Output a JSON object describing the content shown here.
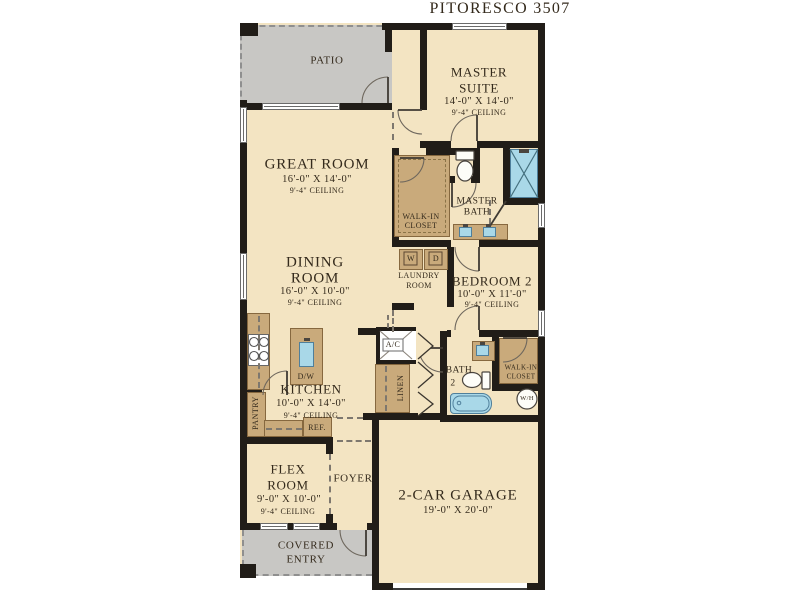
{
  "title": "PITORESCO 3507",
  "colors": {
    "floor": "#f3e4c2",
    "porch": "#c8c7c4",
    "wall": "#211d18",
    "cabinet": "#c9aa7b",
    "fixture_blue": "#a9d8e8",
    "text": "#342a1c"
  },
  "rooms": {
    "patio": {
      "name": "PATIO"
    },
    "master_suite": {
      "name_line1": "MASTER",
      "name_line2": "SUITE",
      "dimensions": "14'-0\" X 14'-0\"",
      "ceiling": "9'-4\" CEILING"
    },
    "great_room": {
      "name": "GREAT ROOM",
      "dimensions": "16'-0\" X 14'-0\"",
      "ceiling": "9'-4\" CEILING"
    },
    "dining_room": {
      "name_line1": "DINING",
      "name_line2": "ROOM",
      "dimensions": "16'-0\" X 10'-0\"",
      "ceiling": "9'-4\" CEILING"
    },
    "kitchen": {
      "name": "KITCHEN",
      "dimensions": "10'-0\" X 14'-0\"",
      "ceiling": "9'-4\" CEILING"
    },
    "flex_room": {
      "name_line1": "FLEX",
      "name_line2": "ROOM",
      "dimensions": "9'-0\" X 10'-0\"",
      "ceiling": "9'-4\" CEILING"
    },
    "foyer": {
      "name": "FOYER"
    },
    "covered_entry": {
      "name_line1": "COVERED",
      "name_line2": "ENTRY"
    },
    "garage": {
      "name": "2-CAR GARAGE",
      "dimensions": "19'-0\" X 20'-0\""
    },
    "bedroom2": {
      "name": "BEDROOM 2",
      "dimensions": "10'-0\" X 11'-0\"",
      "ceiling": "9'-4\" CEILING"
    },
    "master_bath": {
      "name_line1": "MASTER",
      "name_line2": "BATH"
    },
    "master_closet": {
      "name_line1": "WALK-IN",
      "name_line2": "CLOSET"
    },
    "laundry": {
      "name_line1": "LAUNDRY",
      "name_line2": "ROOM"
    },
    "bath2": {
      "name_line1": "BATH",
      "name_line2": "2"
    },
    "closet2": {
      "name_line1": "WALK-IN",
      "name_line2": "CLOSET"
    },
    "linen": {
      "name": "LINEN"
    },
    "pantry": {
      "name": "PANTRY"
    }
  },
  "fixtures": {
    "ac": "A/C",
    "dishwasher": "D/W",
    "refrigerator": "REF.",
    "water_heater": "W/H",
    "washer": "W",
    "dryer": "D"
  }
}
